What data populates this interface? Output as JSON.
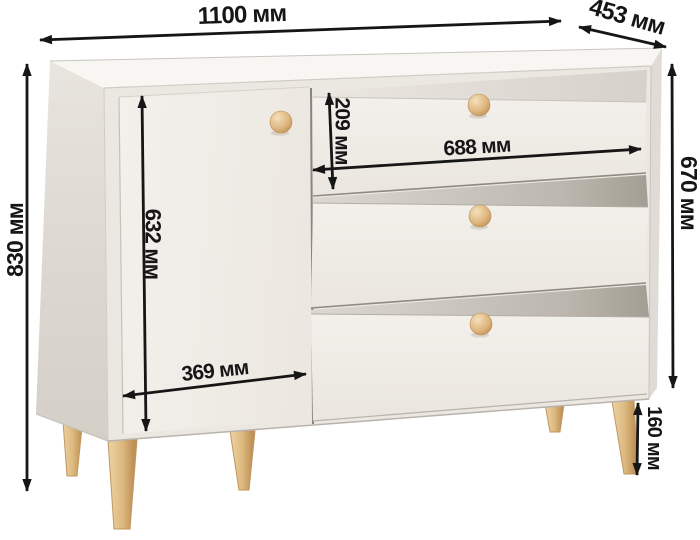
{
  "product": {
    "unit": "мм",
    "labels": {
      "overall_width": "1100 мм",
      "depth": "453 мм",
      "overall_height": "830 мм",
      "carcass_height": "670 мм",
      "door_height": "632 мм",
      "door_width": "369 мм",
      "top_drawer_height": "209 мм",
      "drawer_width": "688 мм",
      "leg_height": "160 мм"
    },
    "values_mm": {
      "overall_width": 1100,
      "depth": 453,
      "overall_height": 830,
      "carcass_height": 670,
      "door_height": 632,
      "door_width": 369,
      "top_drawer_height": 209,
      "drawer_width": 688,
      "leg_height": 160
    }
  },
  "colors": {
    "background": "#ffffff",
    "dimension_ink": "#161616",
    "body_top": "#f8f6f3",
    "body_front": "#ebe7e1",
    "body_side": "#ddd8d1",
    "door_face": "#f1eee8",
    "drawer_face": "#f0ece6",
    "gap_shadow": "#a8a399",
    "wood": "#dcb87e"
  }
}
